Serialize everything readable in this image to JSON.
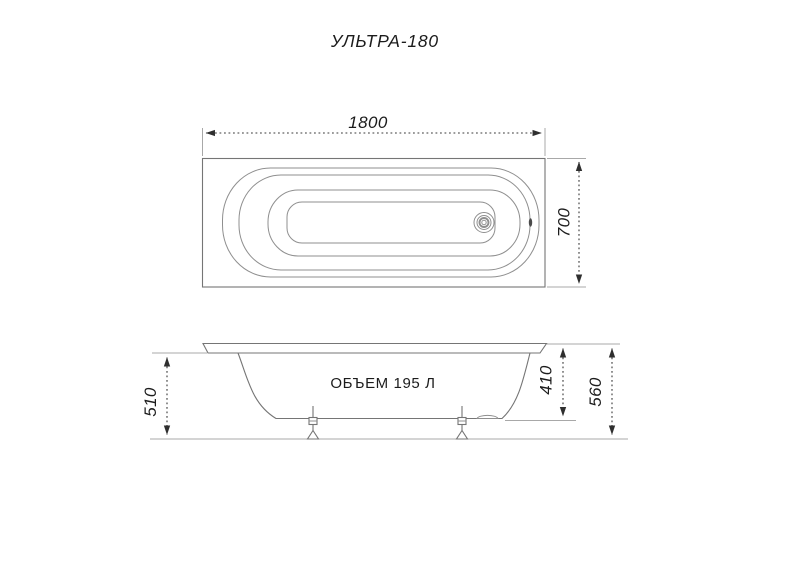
{
  "title": "УЛЬТРА-180",
  "top_view": {
    "length_dim": "1800",
    "width_dim": "700"
  },
  "side_view": {
    "volume_label": "ОБЪЕМ 195 Л",
    "left_height_dim": "510",
    "tub_height_dim": "410",
    "total_height_dim": "560"
  },
  "colors": {
    "drawing_line": "#8f8f8f",
    "outline": "#757575",
    "extension_line": "#a8a8a8",
    "dimension_line": "#383838",
    "text": "#1c1c1c",
    "background": "#ffffff"
  }
}
